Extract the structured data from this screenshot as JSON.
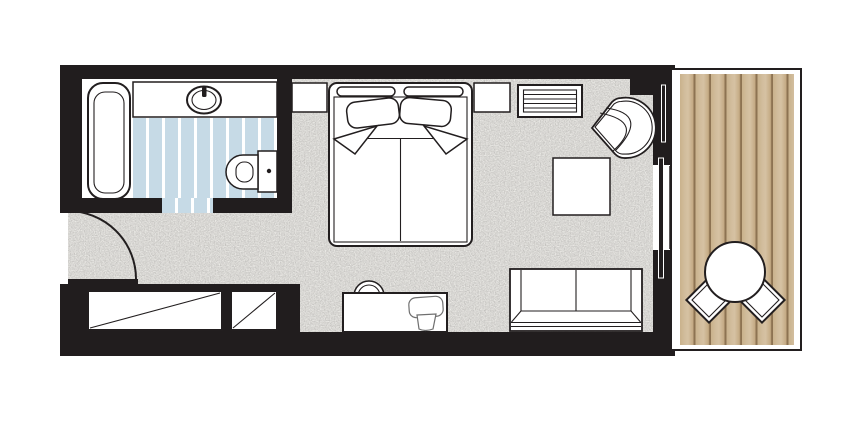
{
  "plan": {
    "title": "hotel-guestroom-floor-plan",
    "colors": {
      "wall": "#211d1e",
      "outline": "#221e1f",
      "floor_base": "#edece8",
      "tile_blue": "#c6dae6",
      "tile_stripe": "#ffffff",
      "deck_wood": "#c9b28c",
      "deck_line": "#8d7352",
      "fixture_fill": "#ffffff"
    },
    "rooms": [
      {
        "name": "bathroom",
        "floor": "blue-striped-tile",
        "fixtures": [
          "bathtub",
          "vanity-counter",
          "oval-sink",
          "faucet",
          "toilet",
          "door-opening"
        ]
      },
      {
        "name": "bedroom",
        "floor": "speckled-carpet",
        "fixtures": [
          "entry-door",
          "wardrobe-large",
          "wardrobe-small",
          "double-bed",
          "headboard-cushions",
          "pillow-left",
          "pillow-right",
          "nightstand-left",
          "nightstand-right",
          "luggage-rack",
          "corner-armchair",
          "side-table",
          "desk",
          "stool",
          "desk-chair",
          "sofa",
          "sliding-glass-door"
        ]
      },
      {
        "name": "balcony",
        "floor": "wood-deck",
        "fixtures": [
          "round-table",
          "balcony-chair-left",
          "balcony-chair-right"
        ]
      }
    ]
  }
}
